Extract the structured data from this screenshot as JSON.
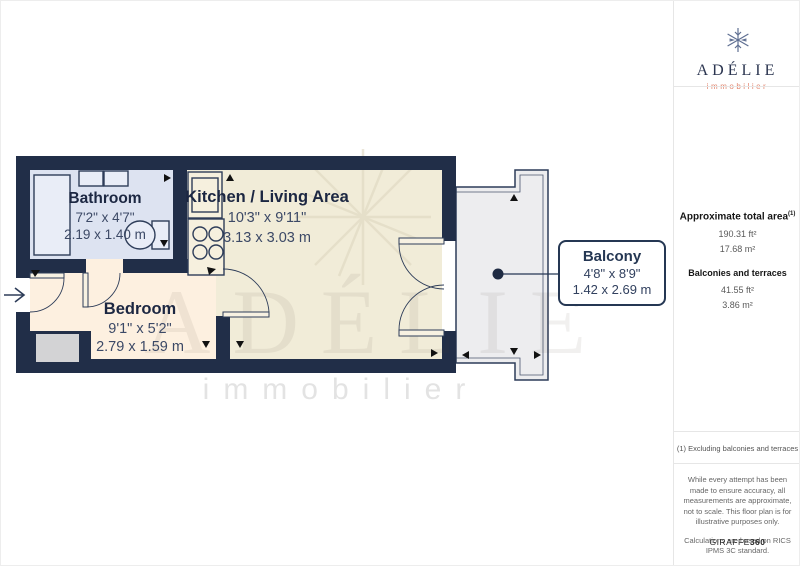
{
  "logo": {
    "brand": "ADÉLIE",
    "tagline": "immobilier"
  },
  "sidebar": {
    "total_area_heading": "Approximate total area",
    "total_area_sup": "(1)",
    "total_area_ft": "190.31 ft²",
    "total_area_m": "17.68 m²",
    "balconies_heading": "Balconies and terraces",
    "balconies_ft": "41.55 ft²",
    "balconies_m": "3.86 m²",
    "note": "(1) Excluding balconies and terraces",
    "disclaimer_1": "While every attempt has been made to ensure accuracy, all measurements are approximate, not to scale. This floor plan is for illustrative purposes only.",
    "disclaimer_2": "Calculations are based on RICS IPMS 3C standard.",
    "footer_brand": "GIRAFFE",
    "footer_suffix": "360"
  },
  "floorplan": {
    "rooms": [
      {
        "name": "Bathroom",
        "imperial": "7'2\" x 4'7\"",
        "metric": "2.19 x 1.40 m"
      },
      {
        "name": "Kitchen / Living Area",
        "imperial": "10'3\" x 9'11\"",
        "metric": "3.13 x 3.03 m"
      },
      {
        "name": "Bedroom",
        "imperial": "9'1\" x 5'2\"",
        "metric": "2.79 x 1.59 m"
      }
    ],
    "callout": {
      "name": "Balcony",
      "imperial": "4'8\" x 8'9\"",
      "metric": "1.42 x 2.69 m"
    },
    "watermark": {
      "word": "ADÉLIE",
      "tagline": "immobilier"
    },
    "colors": {
      "wall": "#212e48",
      "living": "#f1ecd8",
      "bedroom": "#fdf0e0",
      "bathroom": "#dde3f1",
      "balcony": "#ededef",
      "accent": "#e2856e"
    }
  }
}
